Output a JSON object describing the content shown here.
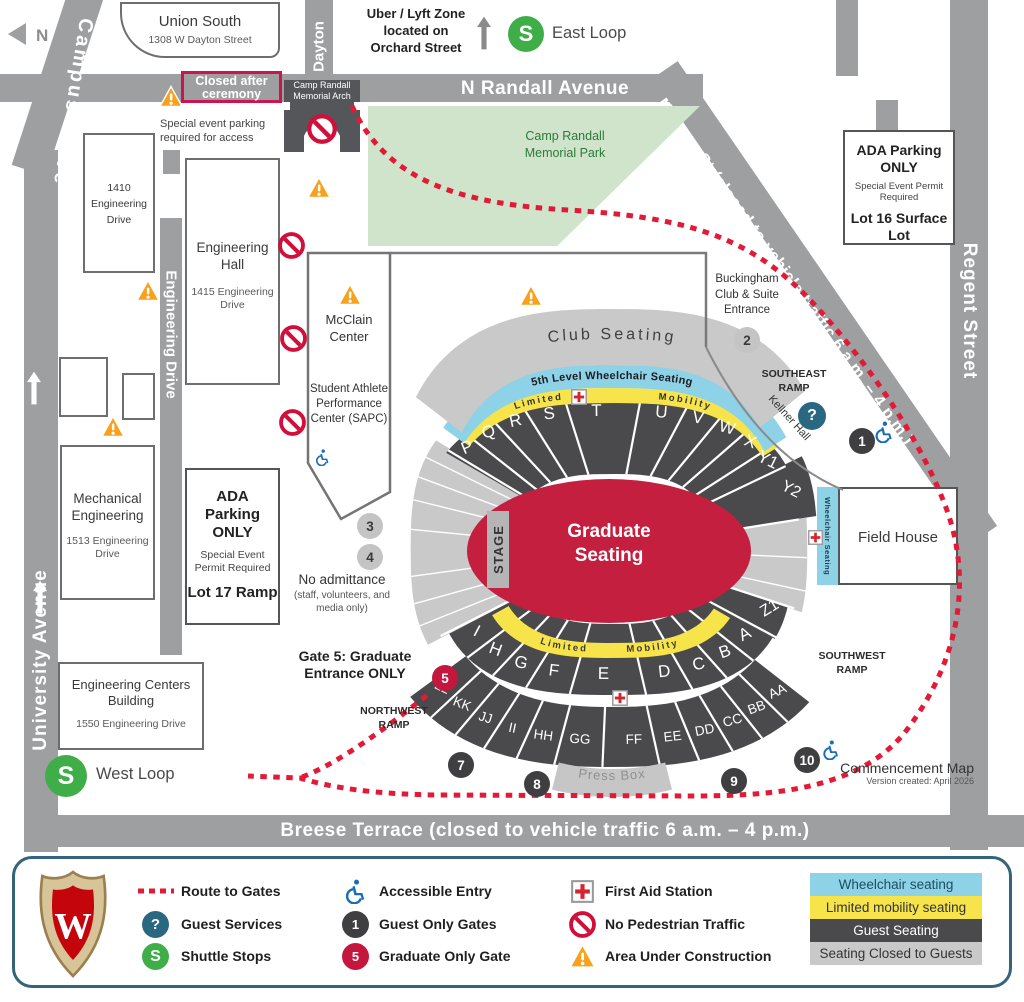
{
  "map": {
    "compass": "N",
    "streets": {
      "campus_drive": "Campus Drive",
      "university_avenue": "University Avenue",
      "engineering_drive": "Engineering Drive",
      "dayton": "Dayton",
      "n_randall": "N Randall Avenue",
      "monroe": "Monroe St (closed to vehicle traffic 6 a.m. – 4 p.m.)",
      "regent": "Regent Street",
      "breese": "Breese Terrace (closed to vehicle traffic 6 a.m. – 4 p.m.)"
    },
    "notes": {
      "uber": "Uber / Lyft Zone located on Orchard Street",
      "closed_after": "Closed after ceremony",
      "special_parking": "Special event parking required for access",
      "no_admittance": "No admittance",
      "no_admittance_sub": "(staff, volunteers, and media only)",
      "gate5_note": "Gate 5: Graduate Entrance ONLY",
      "commencement": "Commencement Map",
      "version": "Version created: April 2026"
    },
    "park": "Camp Randall Memorial Park",
    "arch": "Camp Randall Memorial Arch",
    "shuttle": {
      "glyph": "S",
      "east": "East Loop",
      "west": "West Loop"
    },
    "guest_services_glyph": "?",
    "buildings": {
      "union_south": {
        "name": "Union South",
        "addr": "1308 W Dayton Street"
      },
      "b1410": {
        "name": "1410 Engineering Drive"
      },
      "eng_hall": {
        "name": "Engineering Hall",
        "addr": "1415 Engineering Drive"
      },
      "mcclain": {
        "name": "McClain Center"
      },
      "sapc": {
        "name": "Student Athlete Performance Center (SAPC)"
      },
      "mech": {
        "name": "Mechanical Engineering",
        "addr": "1513 Engineering Drive"
      },
      "ecb": {
        "name": "Engineering Centers Building",
        "addr": "1550 Engineering Drive"
      },
      "field_house": {
        "name": "Field House"
      },
      "kellner": "Kellner Hall",
      "buckingham": "Buckingham Club & Suite Entrance"
    },
    "lots": {
      "lot16": {
        "title": "ADA Parking ONLY",
        "permit": "Special Event Permit Required",
        "name": "Lot 16 Surface Lot"
      },
      "lot17": {
        "title": "ADA Parking ONLY",
        "permit": "Special Event Permit Required",
        "name": "Lot 17 Ramp"
      }
    },
    "ramps": {
      "se": "SOUTHEAST RAMP",
      "sw": "SOUTHWEST RAMP",
      "nw": "NORTHWEST RAMP"
    },
    "stadium": {
      "club_seating": "Club Seating",
      "wheelchair_5th": "5th Level Wheelchair Seating",
      "limited_mobility": [
        "Limited",
        "Mobility"
      ],
      "stage": "STAGE",
      "graduate_seating": "Graduate Seating",
      "wheelchair_strip": "Wheelchair Seating",
      "press_box": "Press Box",
      "upper_sections": [
        "P",
        "Q",
        "R",
        "S",
        "T",
        "U",
        "V",
        "W",
        "X",
        "Y1"
      ],
      "y2": "Y2",
      "z1": "Z1",
      "lower_inner_sections": [
        "A",
        "B",
        "C",
        "D",
        "E",
        "F",
        "G",
        "H",
        "I"
      ],
      "lower_outer_sections": [
        "AA",
        "BB",
        "CC",
        "DD",
        "EE",
        "FF",
        "GG",
        "HH",
        "II",
        "JJ",
        "KK",
        "LL"
      ]
    },
    "gates": [
      {
        "num": "1",
        "kind": "guest"
      },
      {
        "num": "2",
        "kind": "other"
      },
      {
        "num": "3",
        "kind": "other"
      },
      {
        "num": "4",
        "kind": "other"
      },
      {
        "num": "5",
        "kind": "graduate"
      },
      {
        "num": "7",
        "kind": "guest"
      },
      {
        "num": "8",
        "kind": "guest"
      },
      {
        "num": "9",
        "kind": "guest"
      },
      {
        "num": "10",
        "kind": "guest"
      }
    ]
  },
  "legend": {
    "crest_letter": "W",
    "items": [
      {
        "icon": "route-dashes-icon",
        "label": "Route to Gates"
      },
      {
        "icon": "question-circle-icon",
        "glyph": "?",
        "label": "Guest Services"
      },
      {
        "icon": "shuttle-stop-icon",
        "glyph": "S",
        "label": "Shuttle Stops"
      },
      {
        "icon": "accessible-icon",
        "label": "Accessible Entry"
      },
      {
        "icon": "guest-gate-icon",
        "glyph": "1",
        "label": "Guest Only Gates"
      },
      {
        "icon": "graduate-gate-icon",
        "glyph": "5",
        "label": "Graduate Only Gate"
      },
      {
        "icon": "first-aid-icon",
        "label": "First Aid Station"
      },
      {
        "icon": "no-pedestrian-icon",
        "label": "No Pedestrian Traffic"
      },
      {
        "icon": "construction-icon",
        "label": "Area Under Construction"
      }
    ],
    "swatches": [
      {
        "label": "Wheelchair seating",
        "bg": "#8ed2e8",
        "fg": "#1d4e5f"
      },
      {
        "label": "Limited mobility seating",
        "bg": "#f6e44a",
        "fg": "#333333"
      },
      {
        "label": "Guest Seating",
        "bg": "#4a4a4c",
        "fg": "#ffffff"
      },
      {
        "label": "Seating Closed to Guests",
        "bg": "#c9c9c9",
        "fg": "#333333"
      }
    ]
  },
  "colors": {
    "street": "#9e9fa1",
    "dark_seating": "#4a4a4c",
    "closed_seating": "#c9c9c9",
    "wheelchair_blue": "#8ed2e8",
    "limited_yellow": "#f6e44a",
    "graduate_red": "#c51f3f",
    "route_red": "#e21a38",
    "park_green": "#cfe4cb",
    "shuttle_green": "#3fae49",
    "teal": "#2a6882",
    "orange": "#f7a11c"
  }
}
